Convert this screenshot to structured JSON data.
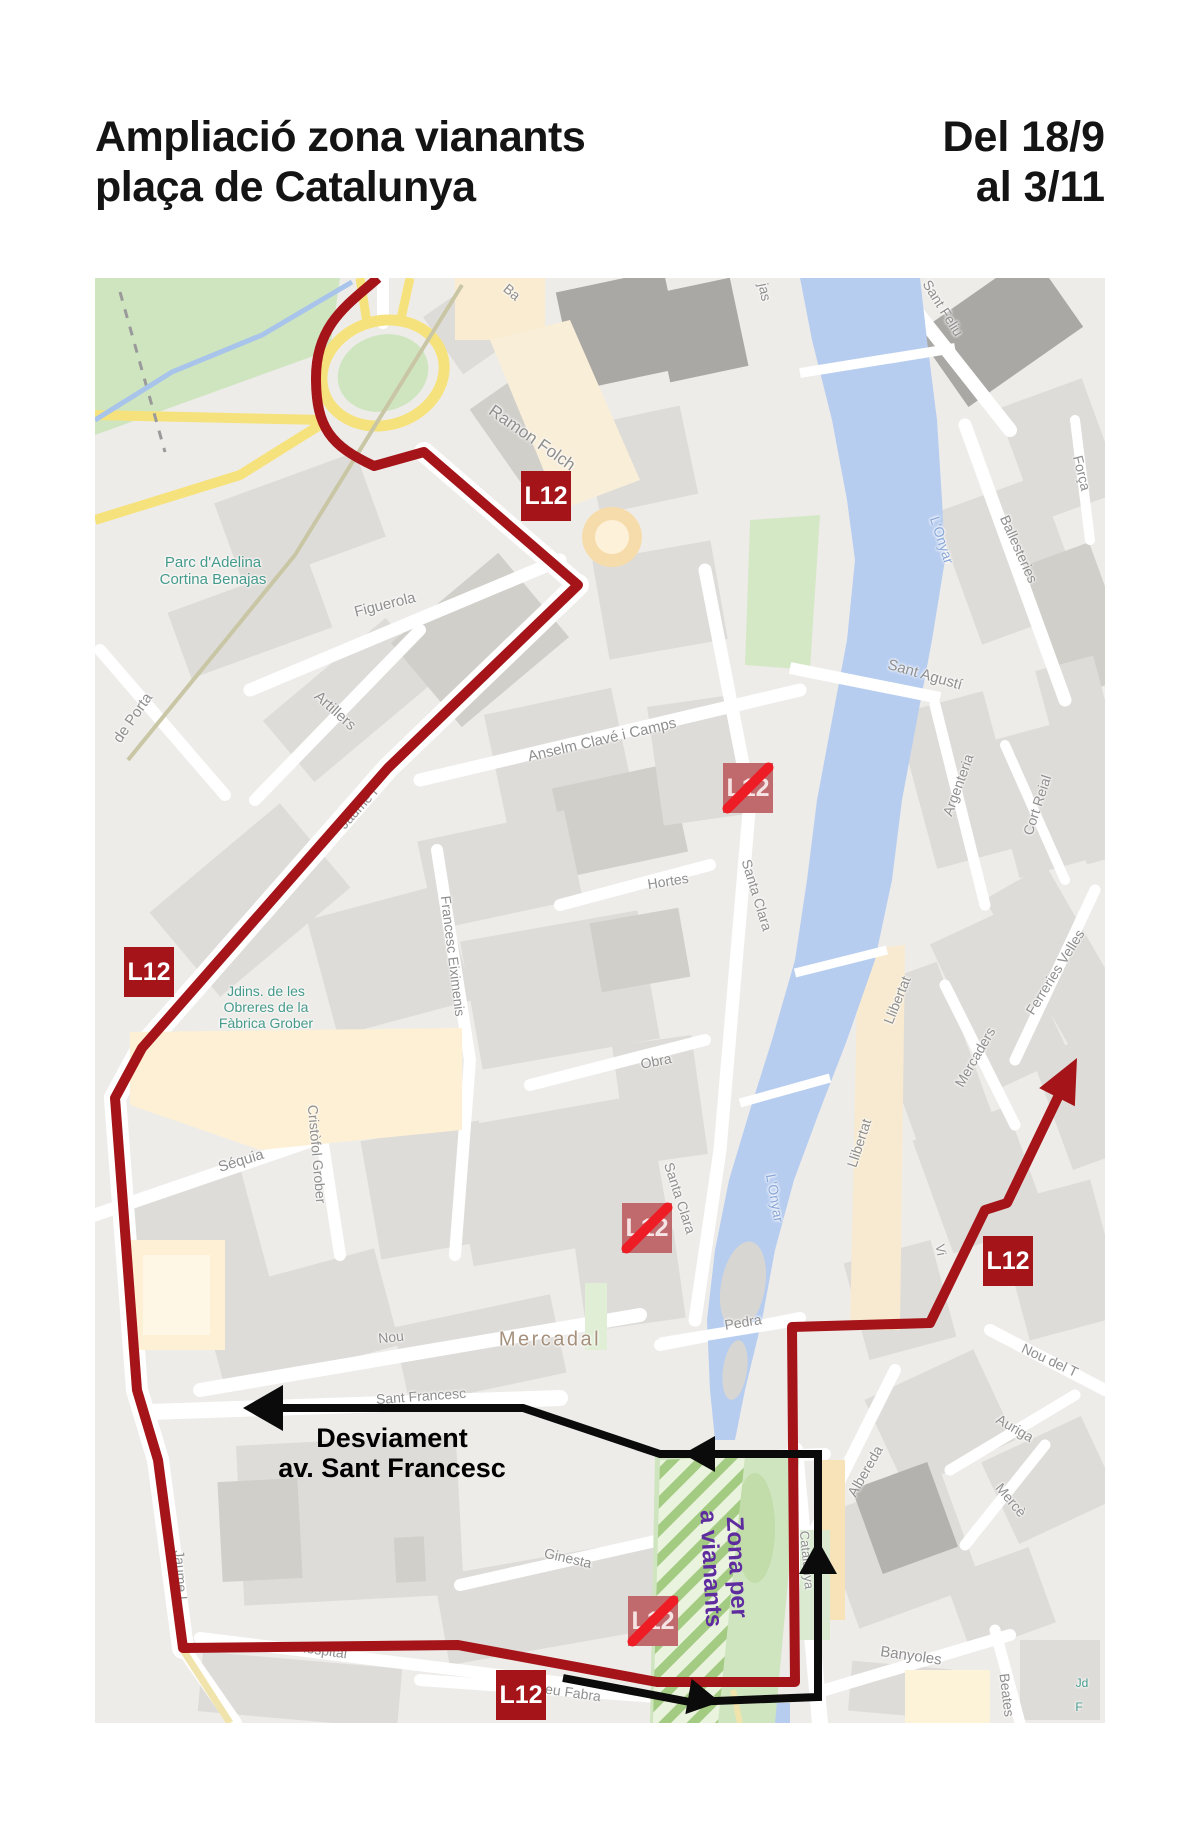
{
  "header": {
    "title_line1": "Ampliació zona vianants",
    "title_line2": "plaça de Catalunya",
    "date_line1": "Del 18/9",
    "date_line2": "al 3/11"
  },
  "annotations": {
    "diversion_line1": "Desviament",
    "diversion_line2": "av. Sant Francesc",
    "zone_line1": "Zona per",
    "zone_line2": "a vianants"
  },
  "colors": {
    "route_red": "#a51419",
    "cancel_slash_red": "#ee1c24",
    "cancelled_badge": "#c06a6e",
    "diversion_black": "#0b0b0b",
    "zone_purple": "#5f2ca0",
    "park_label_teal": "#459a8b",
    "water_blue": "#b7cdf0",
    "water_label_blue": "#8ca8d8",
    "street_label_gray": "#8f8f8f",
    "district_label_brown": "#a5907c",
    "road_yellow": "#f6e27d",
    "park_green": "#cfe5c0",
    "hatch_green": "#a3cb82",
    "cream": "#f8ecd2"
  },
  "map": {
    "badges": [
      {
        "label": "L12",
        "status": "stop",
        "x": 451,
        "y": 218
      },
      {
        "label": "L12",
        "status": "stop",
        "x": 54,
        "y": 694
      },
      {
        "label": "L12",
        "status": "stop",
        "x": 913,
        "y": 983
      },
      {
        "label": "L12",
        "status": "stop",
        "x": 426,
        "y": 1417
      },
      {
        "label": "L12",
        "status": "cancelled",
        "x": 653,
        "y": 510
      },
      {
        "label": "L12",
        "status": "cancelled",
        "x": 552,
        "y": 950
      },
      {
        "label": "L12",
        "status": "cancelled",
        "x": 558,
        "y": 1343
      }
    ],
    "labels": [
      {
        "text": "Ramon Folch",
        "x": 437,
        "y": 160,
        "rot": 35,
        "size": 17
      },
      {
        "text": "Figuerola",
        "x": 290,
        "y": 327,
        "rot": -14,
        "size": 15
      },
      {
        "text": "Artillers",
        "x": 240,
        "y": 433,
        "rot": 42,
        "size": 15
      },
      {
        "text": "de Porta",
        "x": 38,
        "y": 440,
        "rot": -55,
        "size": 15
      },
      {
        "text": "Anselm Clavé i Camps",
        "x": 507,
        "y": 462,
        "rot": -13,
        "size": 15
      },
      {
        "text": "Jaume I",
        "x": 263,
        "y": 530,
        "rot": -48,
        "size": 14
      },
      {
        "text": "Francesc Eiximenis",
        "x": 358,
        "y": 678,
        "rot": 83,
        "size": 14
      },
      {
        "text": "Hortes",
        "x": 573,
        "y": 603,
        "rot": -9,
        "size": 14
      },
      {
        "text": "Santa Clara",
        "x": 662,
        "y": 617,
        "rot": 73,
        "size": 14
      },
      {
        "text": "Obra",
        "x": 561,
        "y": 783,
        "rot": -11,
        "size": 14
      },
      {
        "text": "Séquia",
        "x": 146,
        "y": 883,
        "rot": -17,
        "size": 15
      },
      {
        "text": "Cristòfol Grober",
        "x": 222,
        "y": 876,
        "rot": 85,
        "size": 14
      },
      {
        "text": "Nou",
        "x": 296,
        "y": 1059,
        "rot": -6,
        "size": 14
      },
      {
        "text": "Mercadal",
        "x": 455,
        "y": 1062,
        "rot": 0,
        "size": 20,
        "type": "district"
      },
      {
        "text": "Santa Clara",
        "x": 585,
        "y": 920,
        "rot": 72,
        "size": 14
      },
      {
        "text": "Sant Francesc",
        "x": 326,
        "y": 1118,
        "rot": -4,
        "size": 14
      },
      {
        "text": "Ginesta",
        "x": 473,
        "y": 1280,
        "rot": 13,
        "size": 14
      },
      {
        "text": "Hospital",
        "x": 227,
        "y": 1372,
        "rot": 8,
        "size": 14
      },
      {
        "text": "Pompeu Fabra",
        "x": 460,
        "y": 1412,
        "rot": 8,
        "size": 14
      },
      {
        "text": "Jaume I",
        "x": 86,
        "y": 1297,
        "rot": 86,
        "size": 14
      },
      {
        "text": "Pedra",
        "x": 648,
        "y": 1044,
        "rot": -9,
        "size": 14
      },
      {
        "text": "Catalunya",
        "x": 711,
        "y": 1282,
        "rot": 85,
        "size": 13
      },
      {
        "text": "Albereda",
        "x": 770,
        "y": 1193,
        "rot": -60,
        "size": 14
      },
      {
        "text": "Auriga",
        "x": 920,
        "y": 1150,
        "rot": 30,
        "size": 14
      },
      {
        "text": "Mercè",
        "x": 916,
        "y": 1222,
        "rot": 50,
        "size": 14
      },
      {
        "text": "Banyoles",
        "x": 816,
        "y": 1378,
        "rot": 8,
        "size": 15
      },
      {
        "text": "Beates",
        "x": 912,
        "y": 1417,
        "rot": 83,
        "size": 14
      },
      {
        "text": "Llibertat",
        "x": 802,
        "y": 722,
        "rot": -68,
        "size": 14
      },
      {
        "text": "Llibertat",
        "x": 764,
        "y": 865,
        "rot": -72,
        "size": 14
      },
      {
        "text": "Mercaders",
        "x": 880,
        "y": 779,
        "rot": -60,
        "size": 14
      },
      {
        "text": "Ferreries Velles",
        "x": 960,
        "y": 694,
        "rot": -58,
        "size": 14
      },
      {
        "text": "Argenteria",
        "x": 863,
        "y": 507,
        "rot": -70,
        "size": 14
      },
      {
        "text": "Cort Reial",
        "x": 942,
        "y": 527,
        "rot": -72,
        "size": 14
      },
      {
        "text": "Ballesteries",
        "x": 924,
        "y": 271,
        "rot": 66,
        "size": 14
      },
      {
        "text": "Força",
        "x": 987,
        "y": 195,
        "rot": 76,
        "size": 14
      },
      {
        "text": "Sant Feliu",
        "x": 848,
        "y": 30,
        "rot": 58,
        "size": 14
      },
      {
        "text": "Sant Agustí",
        "x": 830,
        "y": 397,
        "rot": 16,
        "size": 15
      },
      {
        "text": "L'Onyar",
        "x": 847,
        "y": 262,
        "rot": 72,
        "size": 14,
        "type": "water"
      },
      {
        "text": "L'Onyar",
        "x": 680,
        "y": 920,
        "rot": 80,
        "size": 14,
        "type": "water"
      },
      {
        "text": "Nou del T",
        "x": 955,
        "y": 1082,
        "rot": 25,
        "size": 14
      },
      {
        "lines": [
          "Parc d'Adelina",
          "Cortina Benajas"
        ],
        "x": 118,
        "y": 293,
        "rot": 0,
        "size": 15,
        "type": "park"
      },
      {
        "lines": [
          "Jdins. de les",
          "Obreres de la",
          "Fàbrica Grober"
        ],
        "x": 171,
        "y": 729,
        "rot": 0,
        "size": 14,
        "type": "park"
      },
      {
        "text": "jas",
        "x": 670,
        "y": 14,
        "rot": 78,
        "size": 14
      },
      {
        "text": "Ba",
        "x": 417,
        "y": 14,
        "rot": 40,
        "size": 14
      },
      {
        "text": "Jd",
        "x": 987,
        "y": 1406,
        "rot": 0,
        "size": 12,
        "type": "park"
      },
      {
        "text": "F",
        "x": 984,
        "y": 1430,
        "rot": 0,
        "size": 12,
        "type": "park"
      },
      {
        "text": "Vi",
        "x": 845,
        "y": 972,
        "rot": 80,
        "size": 13
      }
    ]
  }
}
